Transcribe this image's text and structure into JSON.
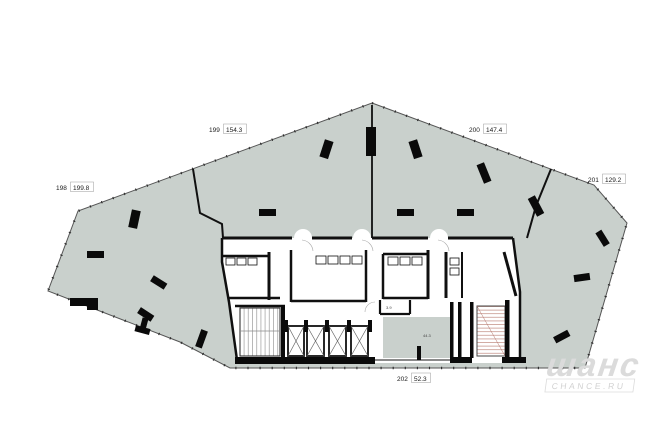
{
  "plan": {
    "type": "architectural-floor-plan",
    "units": [
      {
        "number": "198",
        "area": "199.8"
      },
      {
        "number": "199",
        "area": "154.3"
      },
      {
        "number": "200",
        "area": "147.4"
      },
      {
        "number": "201",
        "area": "129.2"
      },
      {
        "number": "202",
        "area": "52.3"
      }
    ],
    "small_rooms": [
      {
        "area": "3.9"
      },
      {
        "area": "44.3"
      }
    ]
  },
  "watermark": {
    "brand": "шанс",
    "site": "CHANCE.RU"
  },
  "colors": {
    "floor": "#c9d0cc",
    "wall": "#101010",
    "outline": "#555555",
    "stair_hatch": "#b5756a",
    "watermark": "#dbdbdb"
  }
}
